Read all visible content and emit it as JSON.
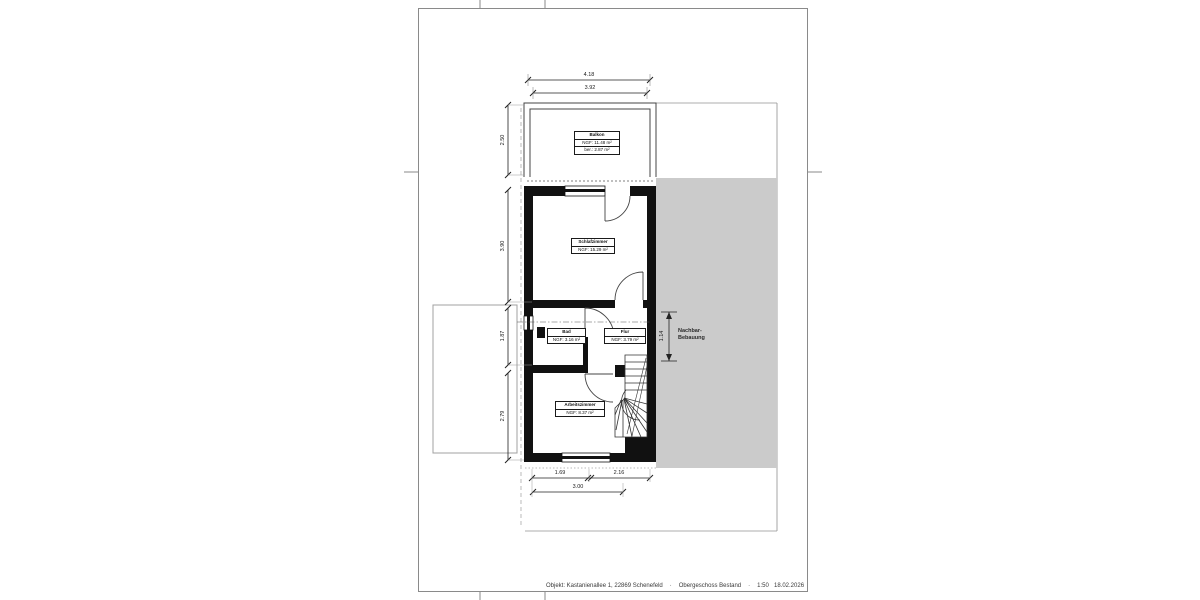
{
  "sheet": {
    "footer": {
      "project": "Objekt: Kastanienallee 1, 22869 Schenefeld",
      "separator": "·",
      "drawing_title": "Obergeschoss Bestand",
      "scale": "1:50",
      "date": "18.02.2026"
    }
  },
  "plan": {
    "rooms": {
      "balkon": {
        "name": "Balkon",
        "area": "NGF: 11.48 m²",
        "area_counted": "ber.: 2.87 m²"
      },
      "schlafzimmer": {
        "name": "Schlafzimmer",
        "area": "NGF: 15.29 m²"
      },
      "bad": {
        "name": "Bad",
        "area": "NGF: 3.16 m²"
      },
      "flur": {
        "name": "Flur",
        "area": "NGF: 3.79 m²"
      },
      "arbeitszimmer": {
        "name": "Arbeitszimmer",
        "area": "NGF: 8.37 m²"
      }
    },
    "neighbor_label": {
      "line1": "Nachbar-",
      "line2": "Bebauung"
    },
    "dimensions": {
      "top_outer": "4.18",
      "top_inner": "3.92",
      "left_balcony": "2.50",
      "left_bedroom": "3.90",
      "left_bath": "1.87",
      "left_study": "2.79",
      "right_offset": "1.14",
      "bottom_left": "1.69",
      "bottom_right": "2.16",
      "bottom_total": "3.00"
    },
    "colors": {
      "neighbor_fill": "#cbcbcb",
      "wall": "#111111"
    }
  }
}
